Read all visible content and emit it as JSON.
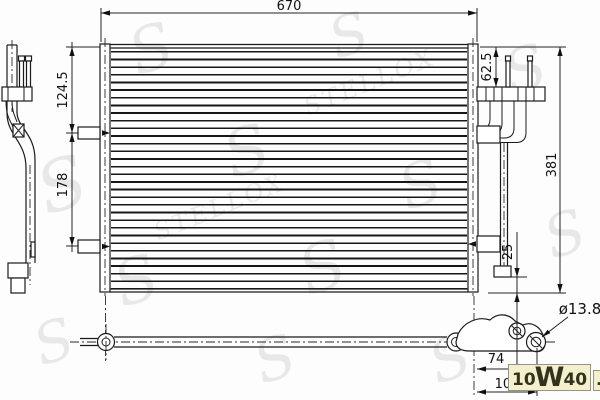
{
  "drawing": {
    "type": "technical-drawing",
    "subject": "ac-condenser",
    "dimensions": {
      "overall_width": "670",
      "left_upper": "124.5",
      "left_mid": "178",
      "right_upper": "62.5",
      "overall_height": "381",
      "bottom_right_offset": "25",
      "pipe_diameter": "ø13.8",
      "fitting_offset_a": "74",
      "fitting_offset_b": "108"
    }
  },
  "watermark": {
    "letter": "S",
    "brand": "STELLOX"
  },
  "site_logo": {
    "p1": "10",
    "p2": "W",
    "p3": "40",
    "tld": ".ru"
  },
  "colors": {
    "line": "#1a1a1a",
    "watermark": "#dcdcdc",
    "logo_bg": "#f4f0cd",
    "logo_text": "#33331c"
  }
}
